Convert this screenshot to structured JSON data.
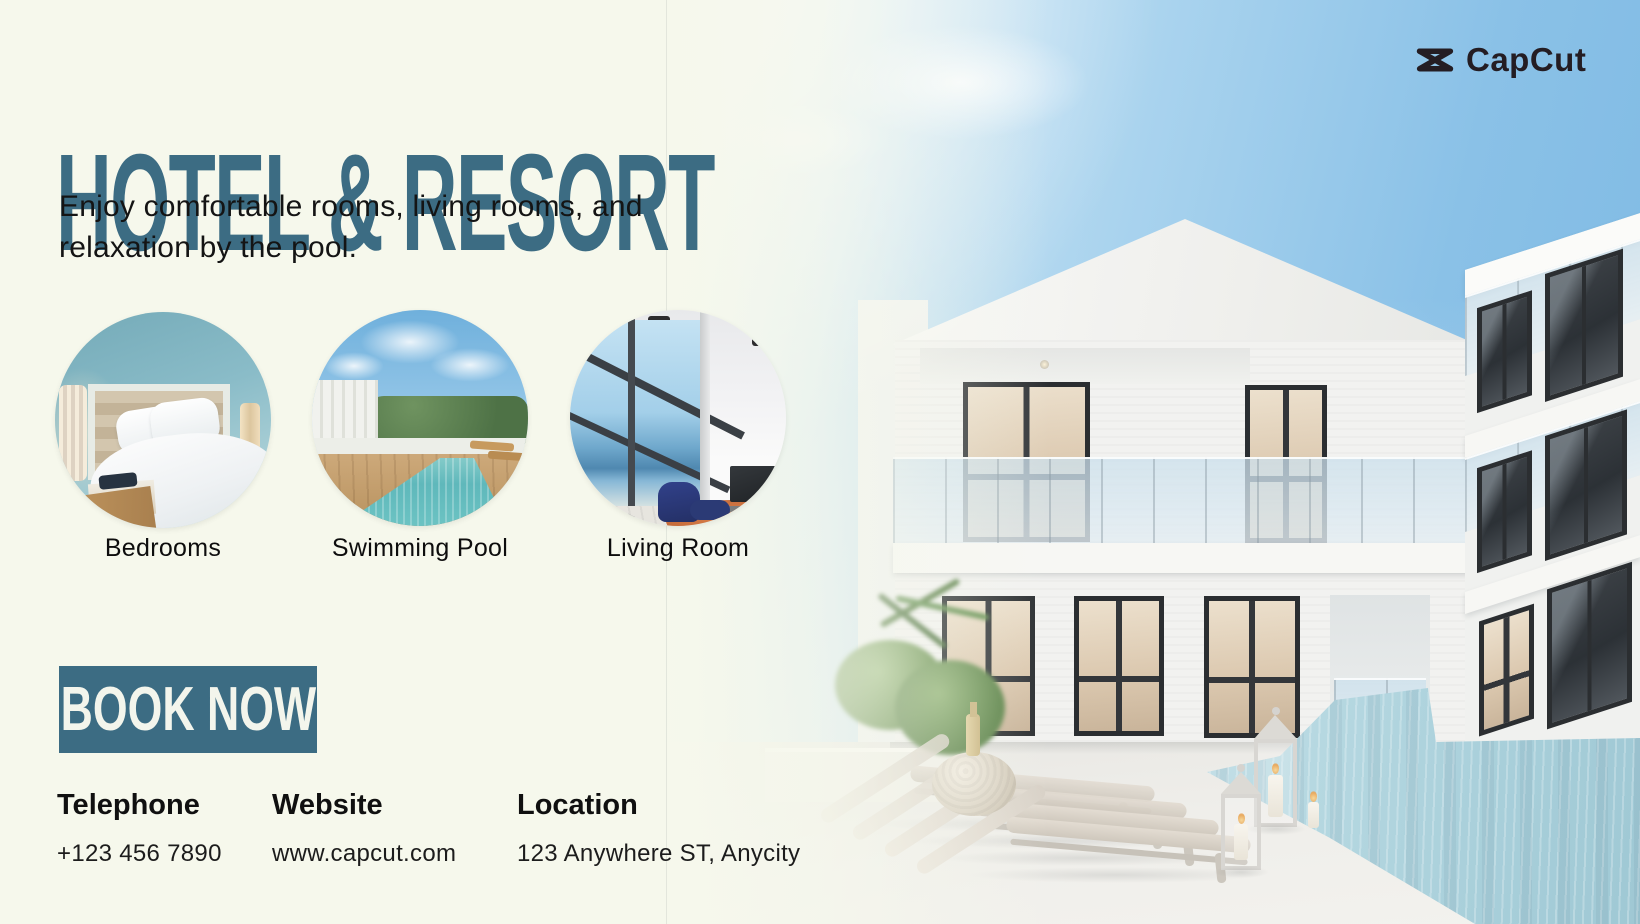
{
  "brand": {
    "name": "CapCut"
  },
  "hero": {
    "title": "HOTEL & RESORT",
    "subtitle_lines": [
      "Enjoy comfortable rooms, living rooms, and",
      "relaxation by the pool."
    ],
    "cta_label": "BOOK NOW"
  },
  "features": [
    {
      "label": "Bedrooms",
      "photo": "bedroom-photo"
    },
    {
      "label": "Swimming Pool",
      "photo": "swimming-pool-photo"
    },
    {
      "label": "Living Room",
      "photo": "living-room-photo"
    }
  ],
  "contact": {
    "columns": [
      {
        "heading": "Telephone",
        "value": "+123 456 7890"
      },
      {
        "heading": "Website",
        "value": "www.capcut.com"
      },
      {
        "heading": "Location",
        "value": "123 Anywhere ST, Anycity"
      }
    ]
  },
  "colors": {
    "accent_teal": "#3c6c83",
    "background_cream": "#f6f8ec",
    "sky_blue": "#7db9e3",
    "pool_water": "#b5d6df",
    "logo_dark": "#241d23",
    "text_dark": "#141414"
  }
}
